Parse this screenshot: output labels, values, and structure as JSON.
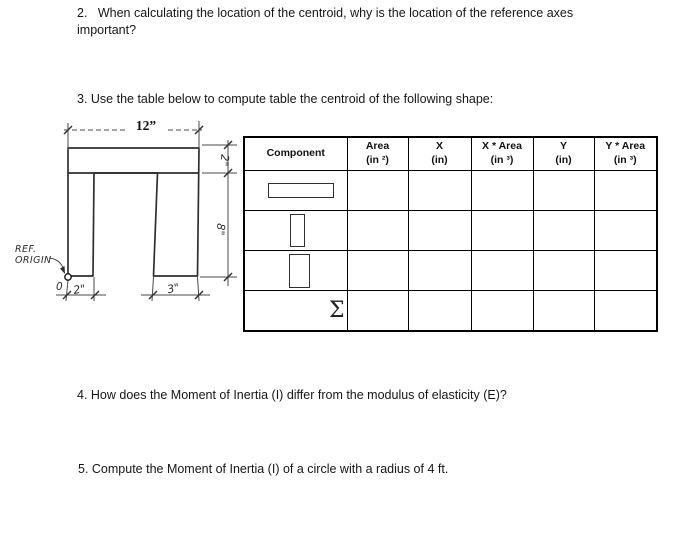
{
  "questions": {
    "q2_line1": "2.   When calculating the location of the centroid, why is the location of the reference axes",
    "q2_line2": "important?",
    "q3": "3. Use the table below to compute table the centroid of the following shape:",
    "q4": "4. How does the Moment of Inertia (I) differ from the modulus of elasticity (E)?",
    "q5": "5. Compute the Moment of Inertia (I) of a circle with a radius of 4 ft."
  },
  "figure": {
    "dim_overall_width": "12”",
    "dim_flange_thickness": "2\"",
    "dim_leg_height": "8\"",
    "dim_left_leg_width": "2\"",
    "dim_right_leg_width": "3\"",
    "ref_label_line1": "REF.",
    "ref_label_line2": "ORIGIN",
    "origin_point": "0",
    "ink_color": "#2f2f2f"
  },
  "table": {
    "headers": [
      {
        "line1": "Component",
        "line2": ""
      },
      {
        "line1": "Area",
        "line2": "(in ²)"
      },
      {
        "line1": "X",
        "line2": "(in)"
      },
      {
        "line1": "X * Area",
        "line2": "(in ³)"
      },
      {
        "line1": "Y",
        "line2": "(in)"
      },
      {
        "line1": "Y * Area",
        "line2": "(in ³)"
      }
    ],
    "sum_symbol": "Σ"
  }
}
